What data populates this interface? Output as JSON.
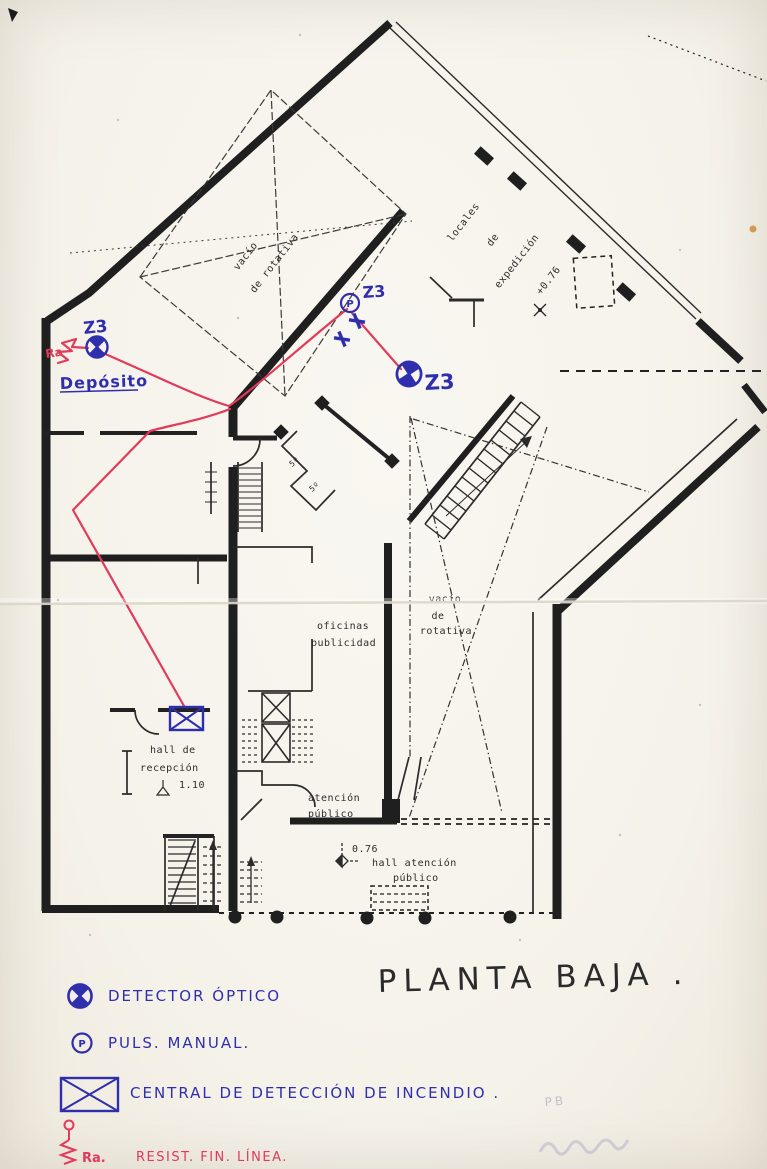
{
  "title": "PLANTA BAJA .",
  "plan": {
    "rotary_void_top": {
      "l1": "vacío",
      "l2": "de rotativa"
    },
    "expedition": {
      "l1": "locales",
      "l2": "de",
      "l3": "expedición"
    },
    "level_top": "+0.76",
    "rotary_void_mid": {
      "l1": "vacío",
      "l2": "de",
      "l3": "rotativa"
    },
    "offices": {
      "l1": "oficinas",
      "l2": "publicidad"
    },
    "reception": {
      "l1": "hall de",
      "l2": "recepción",
      "l3": "1.10"
    },
    "attention": {
      "l1": "atención",
      "l2": "público"
    },
    "hall_attention": {
      "level": "0.76",
      "l1": "hall atención",
      "l2": "público"
    },
    "room_5a": "5º",
    "room_5b": "5º"
  },
  "annotations": {
    "deposit": "Depósito",
    "zone_left": "Z3",
    "zone_callpoint": "Z3",
    "zone_mid": "Z3",
    "callpoint_letter": "P",
    "resistor_tag": "Ra"
  },
  "legend": {
    "detector_label": "DETECTOR ÓPTICO",
    "callpoint_label": "PULS. MANUAL.",
    "callpoint_letter": "P",
    "panel_label": "CENTRAL DE DETECCIÓN DE INCENDIO .",
    "eol_tag": "Ra.",
    "eol_label": "RESIST. FIN. LÍNEA."
  },
  "pencil_note": "PB",
  "colors": {
    "paper": "#f6f4ee",
    "ink": "#1f1f1f",
    "blue": "#2f2fae",
    "red": "#e23a5a",
    "pencil": "#a9a2c0"
  }
}
